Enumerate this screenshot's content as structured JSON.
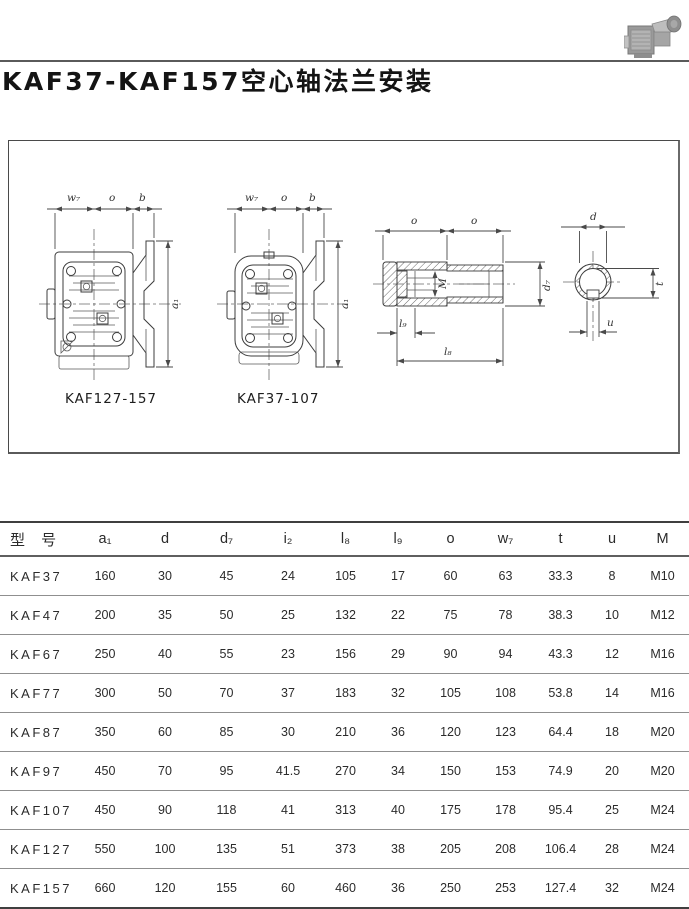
{
  "title": "KAF37-KAF157空心轴法兰安装",
  "diagram": {
    "caption_left": "KAF127-157",
    "caption_right": "KAF37-107",
    "labels": {
      "w7": "w₇",
      "o": "o",
      "b": "b",
      "a1": "a₁",
      "M": "M",
      "d7": "d₇",
      "l9": "l₉",
      "l8": "l₈",
      "d": "d",
      "t": "t",
      "u": "u"
    }
  },
  "table": {
    "headers": [
      "型 号",
      "a₁",
      "d",
      "d₇",
      "i₂",
      "l₈",
      "l₉",
      "o",
      "w₇",
      "t",
      "u",
      "M"
    ],
    "rows": [
      [
        "KAF37",
        "160",
        "30",
        "45",
        "24",
        "105",
        "17",
        "60",
        "63",
        "33.3",
        "8",
        "M10"
      ],
      [
        "KAF47",
        "200",
        "35",
        "50",
        "25",
        "132",
        "22",
        "75",
        "78",
        "38.3",
        "10",
        "M12"
      ],
      [
        "KAF67",
        "250",
        "40",
        "55",
        "23",
        "156",
        "29",
        "90",
        "94",
        "43.3",
        "12",
        "M16"
      ],
      [
        "KAF77",
        "300",
        "50",
        "70",
        "37",
        "183",
        "32",
        "105",
        "108",
        "53.8",
        "14",
        "M16"
      ],
      [
        "KAF87",
        "350",
        "60",
        "85",
        "30",
        "210",
        "36",
        "120",
        "123",
        "64.4",
        "18",
        "M20"
      ],
      [
        "KAF97",
        "450",
        "70",
        "95",
        "41.5",
        "270",
        "34",
        "150",
        "153",
        "74.9",
        "20",
        "M20"
      ],
      [
        "KAF107",
        "450",
        "90",
        "118",
        "41",
        "313",
        "40",
        "175",
        "178",
        "95.4",
        "25",
        "M24"
      ],
      [
        "KAF127",
        "550",
        "100",
        "135",
        "51",
        "373",
        "38",
        "205",
        "208",
        "106.4",
        "28",
        "M24"
      ],
      [
        "KAF157",
        "660",
        "120",
        "155",
        "60",
        "460",
        "36",
        "250",
        "253",
        "127.4",
        "32",
        "M24"
      ]
    ]
  }
}
